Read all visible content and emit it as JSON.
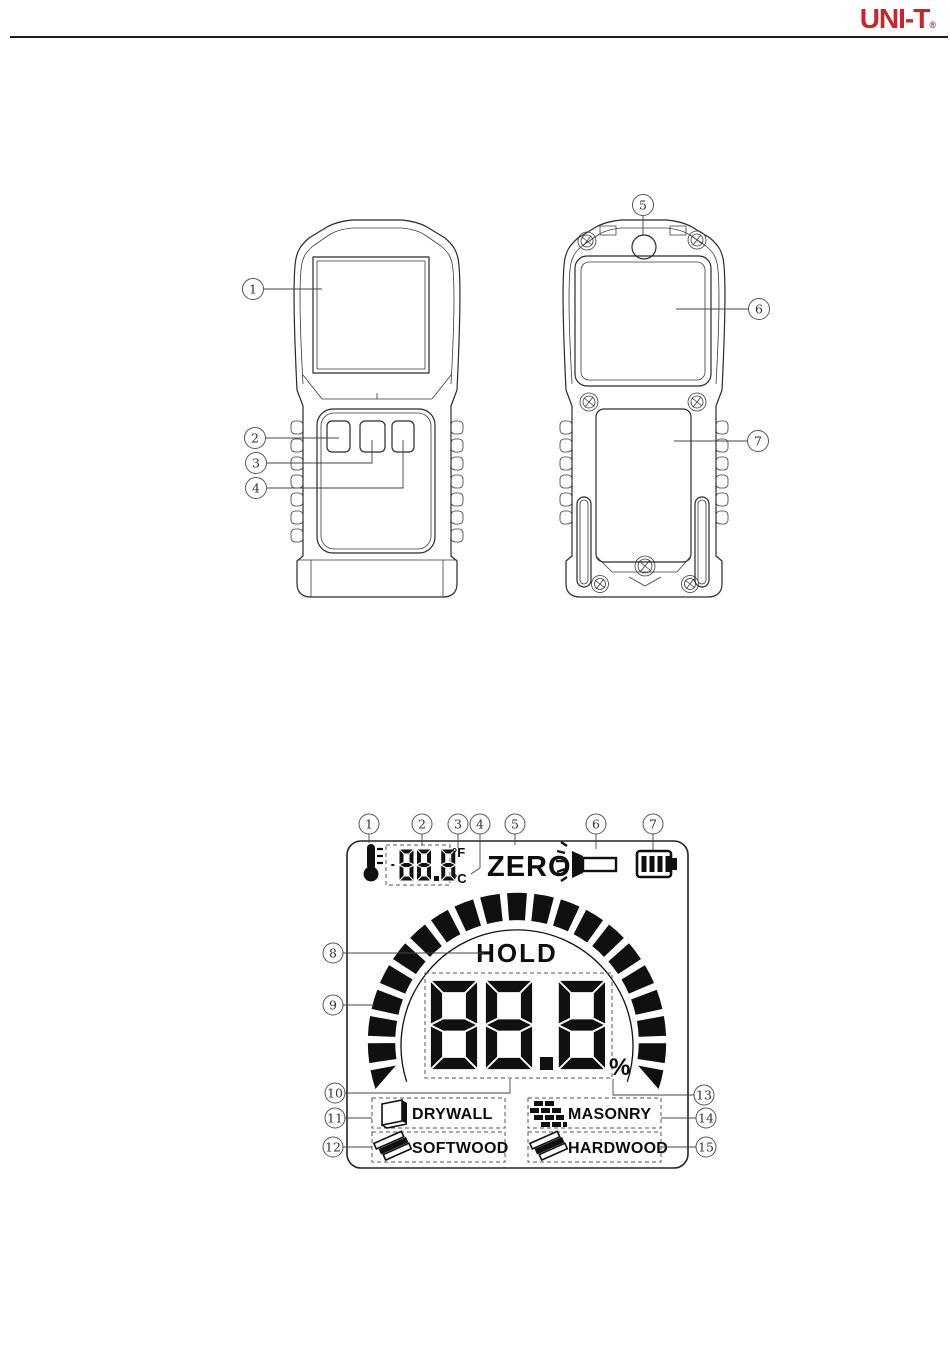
{
  "header": {
    "logo_text": "UNI-T",
    "logo_reg": "®",
    "brand_color": "#c4272e"
  },
  "device_diagram": {
    "front_callouts": [
      "1",
      "2",
      "3",
      "4"
    ],
    "back_callouts": [
      "5",
      "6",
      "7"
    ]
  },
  "lcd_diagram": {
    "top_callouts": [
      "1",
      "2",
      "3",
      "4",
      "5",
      "6",
      "7"
    ],
    "left_callouts": [
      "8",
      "9",
      "10",
      "11",
      "12"
    ],
    "right_callouts": [
      "13",
      "14",
      "15"
    ],
    "temp_display": {
      "value": "-88.8",
      "fahrenheit": "°F",
      "celsius": "°C"
    },
    "zero_label": "ZERO",
    "hold_label": "HOLD",
    "main_display": {
      "value": "88.8",
      "percent": "%"
    },
    "materials": {
      "drywall": "DRYWALL",
      "masonry": "MASONRY",
      "softwood": "SOFTWOOD",
      "hardwood": "HARDWOOD"
    },
    "bar_segments": 21
  },
  "colors": {
    "ink": "#1a1a1a",
    "lcd_ink": "#101010"
  }
}
